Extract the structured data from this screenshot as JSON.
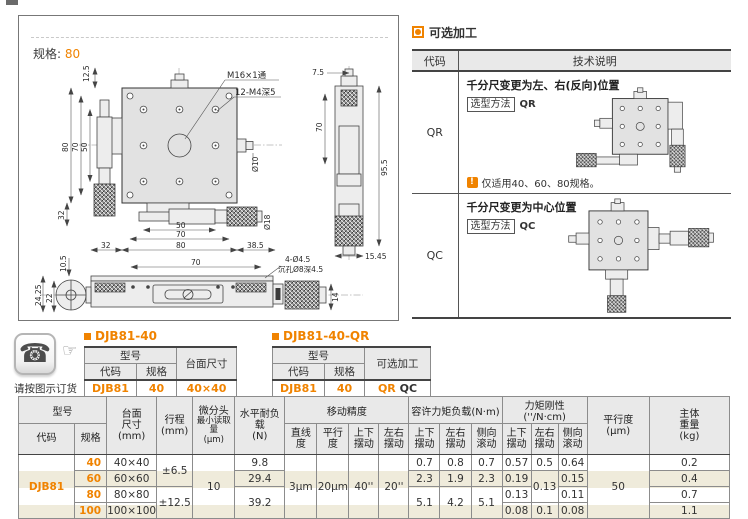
{
  "accent_color": "#f08300",
  "drawing_panel": {
    "spec_label": "规格:",
    "spec_value": "80",
    "dims": {
      "top_12_5": "12.5",
      "left_80": "80",
      "left_70": "70",
      "left_50": "50",
      "left_32": "32",
      "m16": "M16×1通",
      "m4": "12-M4深5",
      "dia10": "Ø10",
      "dia18": "Ø18",
      "bot_32": "32",
      "bot_50": "50",
      "bot_70": "70",
      "bot_80": "80",
      "bot_38_5": "38.5",
      "side_7_5": "7.5",
      "side_70": "70",
      "side_95_5": "95.5",
      "side_15_45": "15.45",
      "front_10_5": "10.5",
      "front_24_25": "24.25",
      "front_22": "22",
      "front_70": "70",
      "front_holes": "4-Ø4.5",
      "front_sink": "沉孔Ø8深4.5",
      "front_14": "14"
    }
  },
  "optional_panel": {
    "title": "可选加工",
    "col_code": "代码",
    "col_desc": "技术说明",
    "rows": [
      {
        "code": "QR",
        "desc_title": "千分尺变更为左、右(反向)位置",
        "method_label": "选型方法",
        "method_value": "QR",
        "note_icon": "!",
        "note": "仅适用40、60、80规格。"
      },
      {
        "code": "QC",
        "desc_title": "千分尺变更为中心位置",
        "method_label": "选型方法",
        "method_value": "QC"
      }
    ]
  },
  "order_note": {
    "phone_icon": "☎",
    "hand_icon": "☞",
    "caption": "请按图示订货"
  },
  "example_tables": [
    {
      "title": "DJB81-40",
      "h_model": "型号",
      "h_code": "代码",
      "h_spec": "规格",
      "h_third": "台面尺寸",
      "code": "DJB81",
      "spec": "40",
      "third_a": "40×40",
      "third_b": ""
    },
    {
      "title": "DJB81-40-QR",
      "h_model": "型号",
      "h_code": "代码",
      "h_spec": "规格",
      "h_third": "可选加工",
      "code": "DJB81",
      "spec": "40",
      "third_a": "QR",
      "third_b": "QC"
    }
  ],
  "spec_table": {
    "headers": {
      "model": "型号",
      "code": "代码",
      "spec": "规格",
      "size": [
        "台面",
        "尺寸",
        "(mm)"
      ],
      "travel": [
        "行程",
        "(mm)"
      ],
      "micro": [
        "微分头",
        "最小读取量",
        "(μm)"
      ],
      "load": [
        "水平耐负载",
        "(N)"
      ],
      "accuracy_group": "移动精度",
      "straight": "直线度",
      "parallel": "平行度",
      "pitch": [
        "上下",
        "摆动"
      ],
      "yaw": [
        "左右",
        "摆动"
      ],
      "moment_group": "容许力矩负载(N·m)",
      "rigidity_group": "力矩刚性(''/N·cm)",
      "roll": [
        "侧向",
        "滚动"
      ],
      "parallel_um": [
        "平行度",
        "(μm)"
      ],
      "weight": [
        "主体",
        "重量",
        "(kg)"
      ]
    },
    "code_value": "DJB81",
    "specs": [
      "40",
      "60",
      "80",
      "100"
    ],
    "sizes": [
      "40×40",
      "60×60",
      "80×80",
      "100×100"
    ],
    "travel_a": "±6.5",
    "travel_b": "±12.5",
    "micro_read": "10",
    "load_40": "9.8",
    "load_60": "29.4",
    "load_80_100": "39.2",
    "straight_val": "3μm",
    "parallel_val": "20μm",
    "pitch_val": "40''",
    "yaw_val": "20''",
    "moment_40": [
      "0.7",
      "0.8",
      "0.7"
    ],
    "moment_60": [
      "2.3",
      "1.9",
      "2.3"
    ],
    "moment_80_100": [
      "5.1",
      "4.2",
      "5.1"
    ],
    "rig_40": [
      "0.57",
      "0.5",
      "0.64"
    ],
    "rig_60_pitch": "0.19",
    "rig_60_80_yaw": "0.13",
    "rig_60_roll": "0.15",
    "rig_80_pitch": "0.13",
    "rig_80_roll": "0.11",
    "rig_100": [
      "0.08",
      "0.1",
      "0.08"
    ],
    "parallel_um_val": "50",
    "weights": [
      "0.2",
      "0.4",
      "0.7",
      "1.1"
    ]
  }
}
